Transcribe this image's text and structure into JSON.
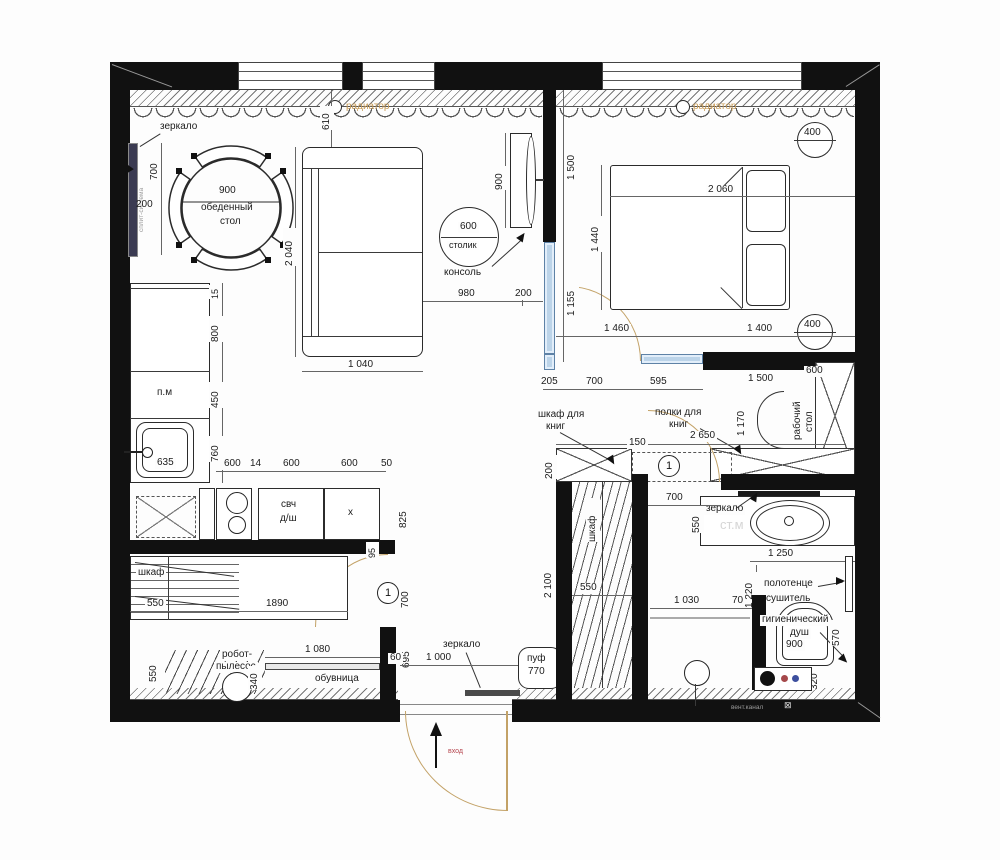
{
  "common": {
    "radiator": "радиатор",
    "door_mark": "1"
  },
  "living": {
    "mirror": "зеркало",
    "split": "сплит-система",
    "d700": "700",
    "d200": "200",
    "table_dim": "900",
    "table1": "обеденный",
    "table2": "стол",
    "d610": "610",
    "sofa_h": "2 040",
    "sofa_w": "1 040",
    "side_dim": "600",
    "side_table": "столик",
    "console": "консоль",
    "console_dim": "900",
    "d980": "980",
    "d200b": "200"
  },
  "bedroom": {
    "d1500": "1 500",
    "d1155": "1 155",
    "d205": "205",
    "d700": "700",
    "d595": "595",
    "bed_w": "2 060",
    "bed_h": "1 440",
    "d400": "400",
    "d1460": "1 460",
    "d1400": "1 400"
  },
  "desk": {
    "l1": "рабочий",
    "l2": "стол",
    "d600": "600",
    "d1500": "1 500",
    "d1170": "1 170",
    "d2650": "2 650"
  },
  "books": {
    "c1": "шкаф для",
    "c2": "книг",
    "p1": "полки для",
    "p2": "книг",
    "d150": "150",
    "d200": "200"
  },
  "kitchen": {
    "pm": "п.м",
    "d635": "635",
    "d15": "15",
    "d800": "800",
    "d450": "450",
    "d760": "760",
    "d600": "600",
    "d14": "14",
    "d50": "50",
    "svch": "свч",
    "dsh": "д/ш",
    "hob": "х",
    "d825": "825"
  },
  "hall": {
    "d95": "95",
    "d700": "700",
    "d695": "695",
    "wardrobe": "шкаф",
    "d550": "550",
    "d1890": "1890",
    "robot1": "робот-",
    "robot2": "пылесос",
    "d340": "340",
    "shoe": "обувница",
    "d1080": "1 080",
    "d60": "60",
    "mirror": "зеркало",
    "pouf": "пуф",
    "pouf_dim": "770",
    "d1000": "1 000",
    "d2100": "2 100",
    "entrance": "вход"
  },
  "closet": {
    "label": "шкаф",
    "d550": "550"
  },
  "bath": {
    "d700": "700",
    "mirror": "зеркало",
    "stm": "ст.м",
    "d550": "550",
    "d1250": "1 250",
    "d1220": "1 220",
    "towel1": "полотенце",
    "towel2": "сушитель",
    "hyg1": "гигиенический",
    "hyg2": "душ",
    "wc_dim": "900",
    "d570": "570",
    "d320": "320",
    "shower_w": "1 030",
    "d70": "70",
    "vent": "вент.канал",
    "vent_sym": "⊠"
  }
}
